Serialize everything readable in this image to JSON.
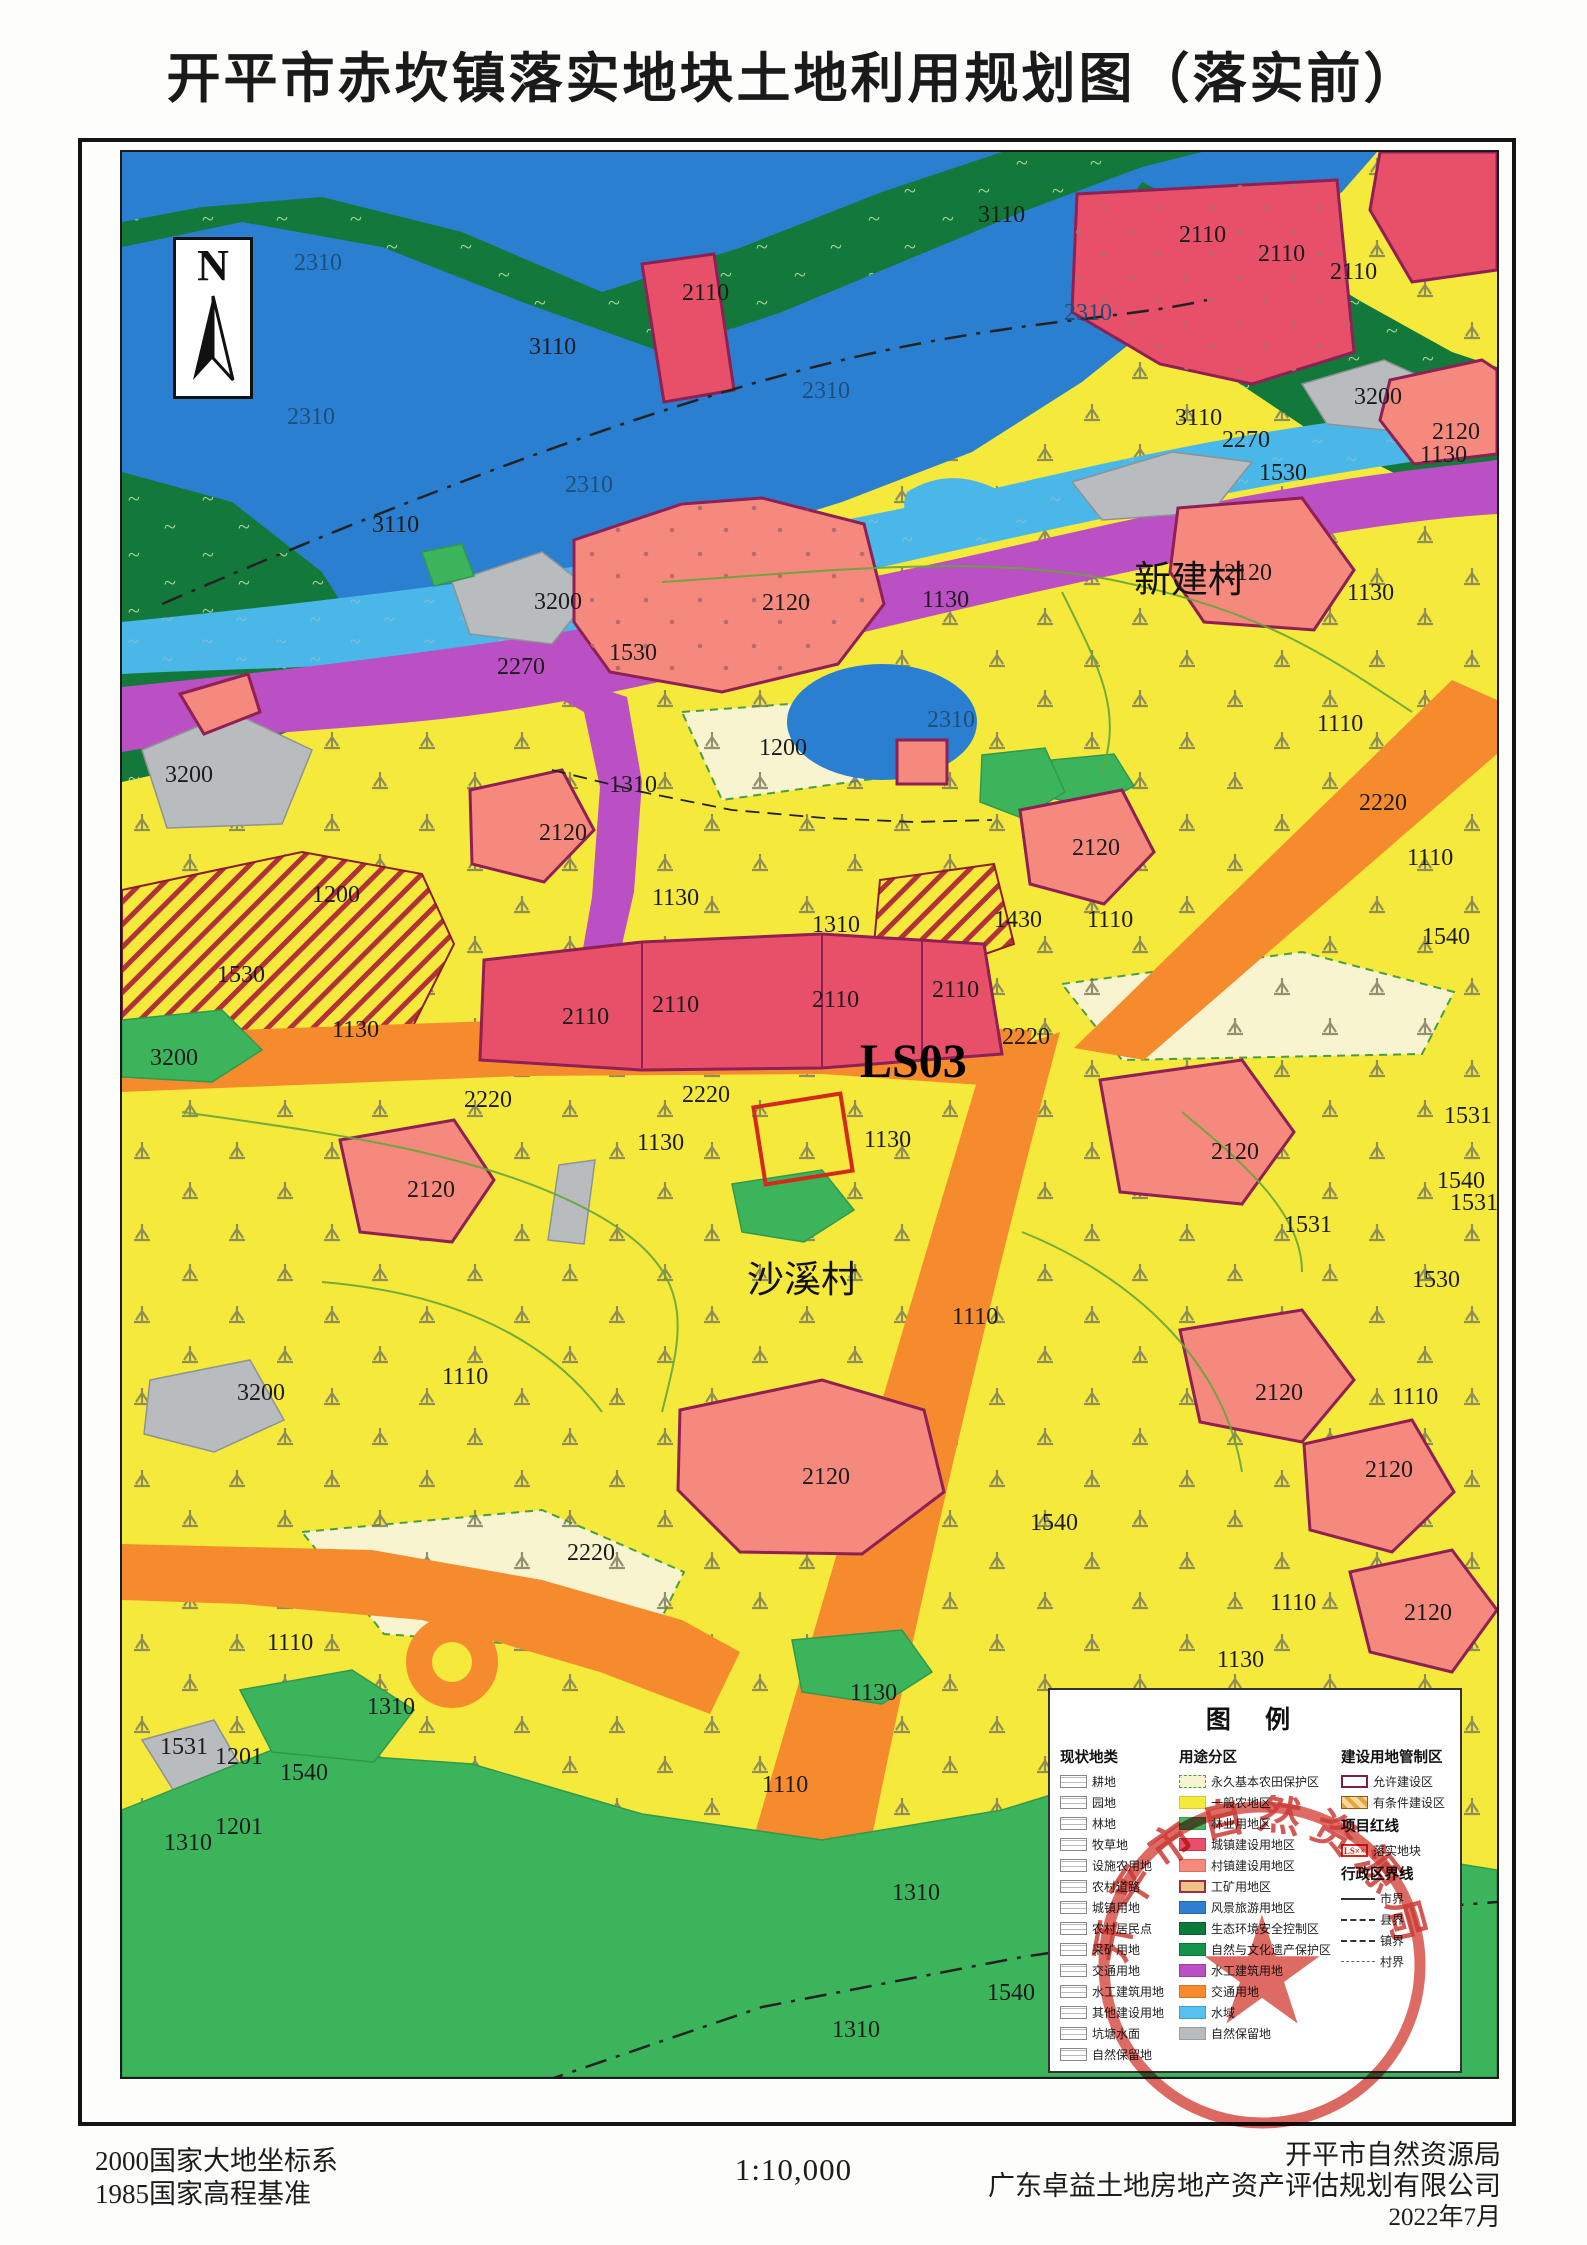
{
  "title": "开平市赤坎镇落实地块土地利用规划图（落实前）",
  "north": {
    "letter": "N"
  },
  "palette": {
    "general_farm_yellow": "#f5e93c",
    "basic_farm_pale": "#f8f4cf",
    "forest_dark": "#12793a",
    "green_mid": "#3cb45c",
    "water_blue": "#2b7fd1",
    "water_cyan": "#49b8e8",
    "urban_red": "#e8506a",
    "village_salmon": "#f5897e",
    "road_orange": "#f68b2e",
    "hydro_purple": "#bb4fc4",
    "reserve_gray": "#b9bcbf",
    "plot_red": "#d42a1c",
    "zone_border_magenta": "#8e2054"
  },
  "map": {
    "labels": [
      {
        "t": "2310",
        "x": 172,
        "y": 118,
        "k": "w"
      },
      {
        "t": "3110",
        "x": 856,
        "y": 70,
        "k": "n"
      },
      {
        "t": "2110",
        "x": 1057,
        "y": 90,
        "k": "n"
      },
      {
        "t": "2110",
        "x": 1136,
        "y": 109,
        "k": "n"
      },
      {
        "t": "2110",
        "x": 1208,
        "y": 127,
        "k": "n"
      },
      {
        "t": "3110",
        "x": 407,
        "y": 202,
        "k": "n"
      },
      {
        "t": "2310",
        "x": 165,
        "y": 272,
        "k": "w"
      },
      {
        "t": "2310",
        "x": 680,
        "y": 246,
        "k": "w"
      },
      {
        "t": "2310",
        "x": 942,
        "y": 168,
        "k": "w"
      },
      {
        "t": "2110",
        "x": 560,
        "y": 148,
        "k": "n"
      },
      {
        "t": "3110",
        "x": 1053,
        "y": 273,
        "k": "n"
      },
      {
        "t": "2270",
        "x": 1100,
        "y": 295,
        "k": "n"
      },
      {
        "t": "3200",
        "x": 1232,
        "y": 252,
        "k": "n"
      },
      {
        "t": "2120",
        "x": 1310,
        "y": 287,
        "k": "n"
      },
      {
        "t": "1130",
        "x": 1298,
        "y": 310,
        "k": "n"
      },
      {
        "t": "2310",
        "x": 443,
        "y": 340,
        "k": "w"
      },
      {
        "t": "3110",
        "x": 250,
        "y": 380,
        "k": "n"
      },
      {
        "t": "1530",
        "x": 1137,
        "y": 328,
        "k": "n"
      },
      {
        "t": "3200",
        "x": 412,
        "y": 457,
        "k": "n"
      },
      {
        "t": "2270",
        "x": 375,
        "y": 522,
        "k": "n"
      },
      {
        "t": "1530",
        "x": 487,
        "y": 508,
        "k": "n"
      },
      {
        "t": "2120",
        "x": 640,
        "y": 458,
        "k": "n"
      },
      {
        "t": "1130",
        "x": 800,
        "y": 455,
        "k": "n"
      },
      {
        "t": "新建村",
        "x": 1012,
        "y": 440,
        "k": "v"
      },
      {
        "t": "2120",
        "x": 1102,
        "y": 428,
        "k": "n"
      },
      {
        "t": "1130",
        "x": 1225,
        "y": 448,
        "k": "n"
      },
      {
        "t": "2310",
        "x": 805,
        "y": 575,
        "k": "w"
      },
      {
        "t": "3200",
        "x": 43,
        "y": 630,
        "k": "n"
      },
      {
        "t": "1200",
        "x": 637,
        "y": 603,
        "k": "n"
      },
      {
        "t": "1310",
        "x": 487,
        "y": 640,
        "k": "n"
      },
      {
        "t": "2120",
        "x": 417,
        "y": 688,
        "k": "n"
      },
      {
        "t": "1110",
        "x": 1195,
        "y": 579,
        "k": "n"
      },
      {
        "t": "2220",
        "x": 1237,
        "y": 658,
        "k": "n"
      },
      {
        "t": "1110",
        "x": 1285,
        "y": 713,
        "k": "n"
      },
      {
        "t": "1130",
        "x": 530,
        "y": 753,
        "k": "n"
      },
      {
        "t": "1310",
        "x": 690,
        "y": 780,
        "k": "n"
      },
      {
        "t": "2120",
        "x": 950,
        "y": 703,
        "k": "n"
      },
      {
        "t": "1430",
        "x": 872,
        "y": 775,
        "k": "n"
      },
      {
        "t": "1110",
        "x": 965,
        "y": 775,
        "k": "n"
      },
      {
        "t": "1540",
        "x": 1300,
        "y": 792,
        "k": "n"
      },
      {
        "t": "1200",
        "x": 190,
        "y": 750,
        "k": "n"
      },
      {
        "t": "1530",
        "x": 95,
        "y": 830,
        "k": "n"
      },
      {
        "t": "1130",
        "x": 210,
        "y": 885,
        "k": "n"
      },
      {
        "t": "3200",
        "x": 28,
        "y": 913,
        "k": "n"
      },
      {
        "t": "2110",
        "x": 440,
        "y": 872,
        "k": "n"
      },
      {
        "t": "2110",
        "x": 530,
        "y": 860,
        "k": "n"
      },
      {
        "t": "2110",
        "x": 690,
        "y": 855,
        "k": "n"
      },
      {
        "t": "2110",
        "x": 810,
        "y": 845,
        "k": "n"
      },
      {
        "t": "2220",
        "x": 342,
        "y": 955,
        "k": "n"
      },
      {
        "t": "2220",
        "x": 560,
        "y": 950,
        "k": "n"
      },
      {
        "t": "LS03",
        "x": 738,
        "y": 925,
        "k": "big"
      },
      {
        "t": "1130",
        "x": 515,
        "y": 998,
        "k": "n"
      },
      {
        "t": "1130",
        "x": 742,
        "y": 995,
        "k": "n"
      },
      {
        "t": "2220",
        "x": 880,
        "y": 892,
        "k": "n"
      },
      {
        "t": "2120",
        "x": 1089,
        "y": 1007,
        "k": "n"
      },
      {
        "t": "1531",
        "x": 1322,
        "y": 971,
        "k": "n"
      },
      {
        "t": "1540",
        "x": 1315,
        "y": 1036,
        "k": "n"
      },
      {
        "t": "1531",
        "x": 1328,
        "y": 1058,
        "k": "n"
      },
      {
        "t": "2120",
        "x": 285,
        "y": 1045,
        "k": "n"
      },
      {
        "t": "1531",
        "x": 1162,
        "y": 1080,
        "k": "n"
      },
      {
        "t": "沙溪村",
        "x": 625,
        "y": 1140,
        "k": "v"
      },
      {
        "t": "1530",
        "x": 1290,
        "y": 1135,
        "k": "n"
      },
      {
        "t": "1110",
        "x": 830,
        "y": 1172,
        "k": "n"
      },
      {
        "t": "3200",
        "x": 115,
        "y": 1248,
        "k": "n"
      },
      {
        "t": "1110",
        "x": 320,
        "y": 1232,
        "k": "n"
      },
      {
        "t": "2120",
        "x": 1133,
        "y": 1248,
        "k": "n"
      },
      {
        "t": "1110",
        "x": 1270,
        "y": 1252,
        "k": "n"
      },
      {
        "t": "2120",
        "x": 1243,
        "y": 1325,
        "k": "n"
      },
      {
        "t": "2120",
        "x": 680,
        "y": 1332,
        "k": "n"
      },
      {
        "t": "1540",
        "x": 908,
        "y": 1378,
        "k": "n"
      },
      {
        "t": "2220",
        "x": 445,
        "y": 1408,
        "k": "n"
      },
      {
        "t": "1110",
        "x": 1148,
        "y": 1458,
        "k": "n"
      },
      {
        "t": "2120",
        "x": 1282,
        "y": 1468,
        "k": "n"
      },
      {
        "t": "1110",
        "x": 145,
        "y": 1498,
        "k": "n"
      },
      {
        "t": "1130",
        "x": 1095,
        "y": 1515,
        "k": "n"
      },
      {
        "t": "1310",
        "x": 245,
        "y": 1562,
        "k": "n"
      },
      {
        "t": "1130",
        "x": 728,
        "y": 1548,
        "k": "n"
      },
      {
        "t": "1531",
        "x": 38,
        "y": 1602,
        "k": "n"
      },
      {
        "t": "1201",
        "x": 93,
        "y": 1612,
        "k": "n"
      },
      {
        "t": "1540",
        "x": 158,
        "y": 1628,
        "k": "n"
      },
      {
        "t": "1201",
        "x": 93,
        "y": 1682,
        "k": "n"
      },
      {
        "t": "1310",
        "x": 42,
        "y": 1698,
        "k": "n"
      },
      {
        "t": "1110",
        "x": 640,
        "y": 1640,
        "k": "n"
      },
      {
        "t": "1310",
        "x": 770,
        "y": 1748,
        "k": "n"
      },
      {
        "t": "1540",
        "x": 865,
        "y": 1848,
        "k": "n"
      },
      {
        "t": "1310",
        "x": 710,
        "y": 1885,
        "k": "n"
      }
    ]
  },
  "legend": {
    "title": "图 例",
    "col1": {
      "header": "现状地类",
      "items": [
        {
          "label": "耕地"
        },
        {
          "label": "园地"
        },
        {
          "label": "林地"
        },
        {
          "label": "牧草地"
        },
        {
          "label": "设施农用地"
        },
        {
          "label": "农村道路"
        },
        {
          "label": "城镇用地"
        },
        {
          "label": "农村居民点"
        },
        {
          "label": "采矿用地"
        },
        {
          "label": "交通用地"
        },
        {
          "label": "水工建筑用地"
        },
        {
          "label": "其他建设用地"
        },
        {
          "label": "坑塘水面"
        },
        {
          "label": "自然保留地"
        }
      ]
    },
    "col2": {
      "header": "用途分区",
      "items": [
        {
          "label": "永久基本农田保护区",
          "color": "#f8f4cf",
          "border": "1px dashed #4a9e3f"
        },
        {
          "label": "一般农地区",
          "color": "#f5e93c",
          "border": "1px solid #d6ca2a"
        },
        {
          "label": "林业用地区",
          "color": "#4cb05e",
          "border": "1px solid #3a9a4c"
        },
        {
          "label": "城镇建设用地区",
          "color": "#e8506a",
          "border": "1px solid #c93b55"
        },
        {
          "label": "村镇建设用地区",
          "color": "#f5897e",
          "border": "1px solid #d9705f"
        },
        {
          "label": "工矿用地区",
          "color": "#f0c288",
          "border": "2px solid #9c2f3f"
        },
        {
          "label": "风景旅游用地区",
          "color": "#2f7fd0",
          "border": "1px solid #24669f"
        },
        {
          "label": "生态环境安全控制区",
          "color": "#0c7a3a",
          "border": "1px solid #09602e"
        },
        {
          "label": "自然与文化遗产保护区",
          "color": "#12944a",
          "border": "1px solid #0d7339"
        },
        {
          "label": "水工建筑用地",
          "color": "#bb4fc4",
          "border": "1px solid #9a3da2"
        },
        {
          "label": "交通用地",
          "color": "#f68b2e",
          "border": "1px solid #d87420"
        },
        {
          "label": "水域",
          "color": "#57c0ee",
          "border": "1px solid #3fa3cf"
        },
        {
          "label": "自然保留地",
          "color": "#b9bcbf",
          "border": "1px solid #9a9da0"
        }
      ]
    },
    "col3": {
      "header1": "建设用地管制区",
      "items1": [
        {
          "label": "允许建设区",
          "type": "allow"
        },
        {
          "label": "有条件建设区",
          "type": "cond"
        }
      ],
      "header2": "项目红线",
      "items2": [
        {
          "label": "落实地块",
          "swatch_text": "LS××",
          "type": "plot"
        }
      ],
      "header3": "行政区界线",
      "items3": [
        {
          "label": "市界",
          "line": "city"
        },
        {
          "label": "县界",
          "line": "county"
        },
        {
          "label": "镇界",
          "line": "town"
        },
        {
          "label": "村界",
          "line": "village"
        }
      ]
    }
  },
  "stamp": {
    "arc_text": "开平市自然资源局",
    "star": "★"
  },
  "footer": {
    "datum1": "2000国家大地坐标系",
    "datum2": "1985国家高程基准",
    "scale": "1:10,000",
    "org1": "开平市自然资源局",
    "org2": "广东卓益土地房地产资产评估规划有限公司",
    "date": "2022年7月"
  }
}
